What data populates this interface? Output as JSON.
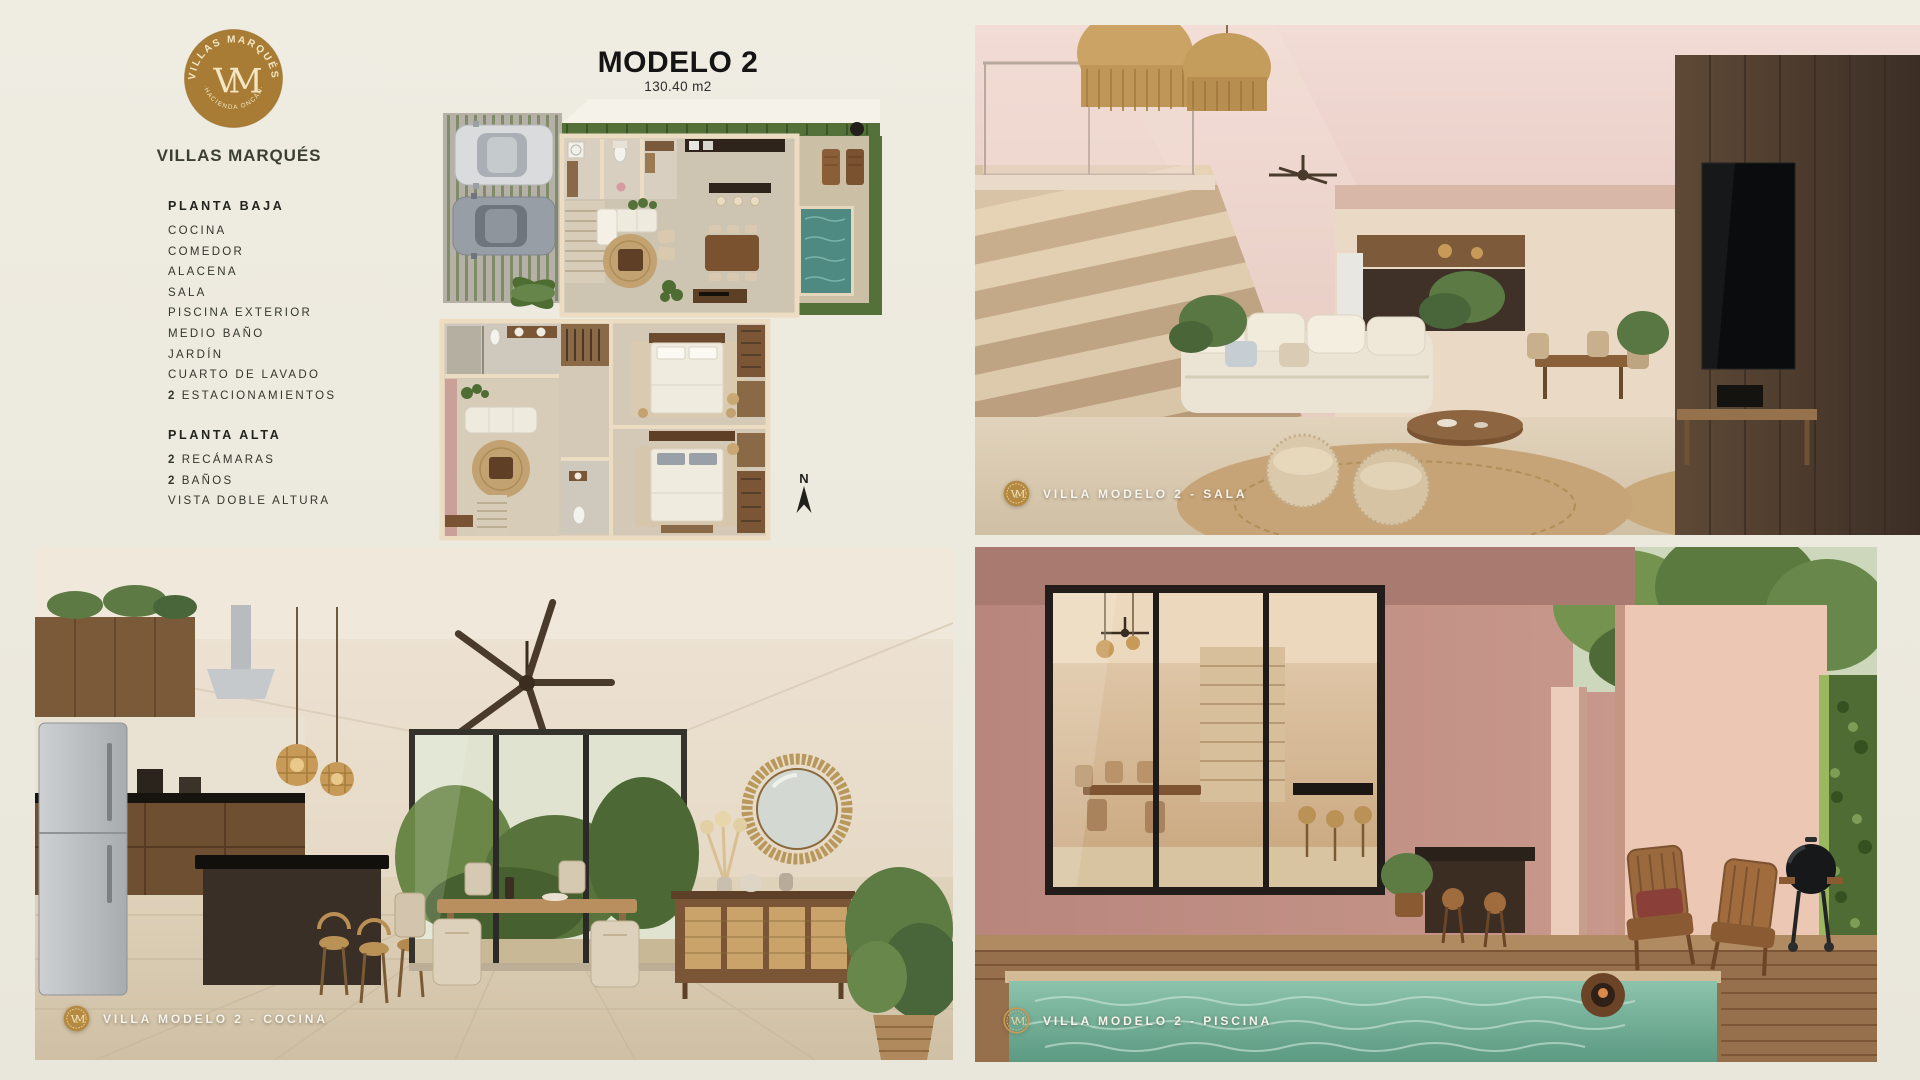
{
  "colors": {
    "paper": "#edeae0",
    "brand_gold": "#a87c35",
    "text_dark": "#33362c",
    "caption_text": "#f6f3ea",
    "pool_teal": "#5c9a82",
    "wall_pink": "#e5c8bf",
    "wood_brown": "#7a5636"
  },
  "brand": {
    "name": "VILLAS MARQUÉS",
    "badge_top": "VILLAS MARQUÉS",
    "badge_bottom": "·HACIENDA ONCÁN·",
    "monogram": "VM"
  },
  "model": {
    "title": "MODELO 2",
    "area": "130.40 m2"
  },
  "floors": [
    {
      "title": "PLANTA BAJA",
      "items": [
        {
          "prefix": "",
          "label": "COCINA"
        },
        {
          "prefix": "",
          "label": "COMEDOR"
        },
        {
          "prefix": "",
          "label": "ALACENA"
        },
        {
          "prefix": "",
          "label": "SALA"
        },
        {
          "prefix": "",
          "label": "PISCINA EXTERIOR"
        },
        {
          "prefix": "",
          "label": "MEDIO BAÑO"
        },
        {
          "prefix": "",
          "label": "JARDÍN"
        },
        {
          "prefix": "",
          "label": "CUARTO DE LAVADO"
        },
        {
          "prefix": "2",
          "label": "ESTACIONAMIENTOS"
        }
      ]
    },
    {
      "title": "PLANTA ALTA",
      "items": [
        {
          "prefix": "2",
          "label": "RECÁMARAS"
        },
        {
          "prefix": "2",
          "label": "BAÑOS"
        },
        {
          "prefix": "",
          "label": "VISTA DOBLE ALTURA"
        }
      ]
    }
  ],
  "compass": {
    "label": "N"
  },
  "photos": {
    "sala": {
      "caption": "VILLA MODELO 2 - SALA"
    },
    "cocina": {
      "caption": "VILLA MODELO 2 - COCINA"
    },
    "piscina": {
      "caption": "VILLA MODELO 2 - PISCINA"
    }
  }
}
